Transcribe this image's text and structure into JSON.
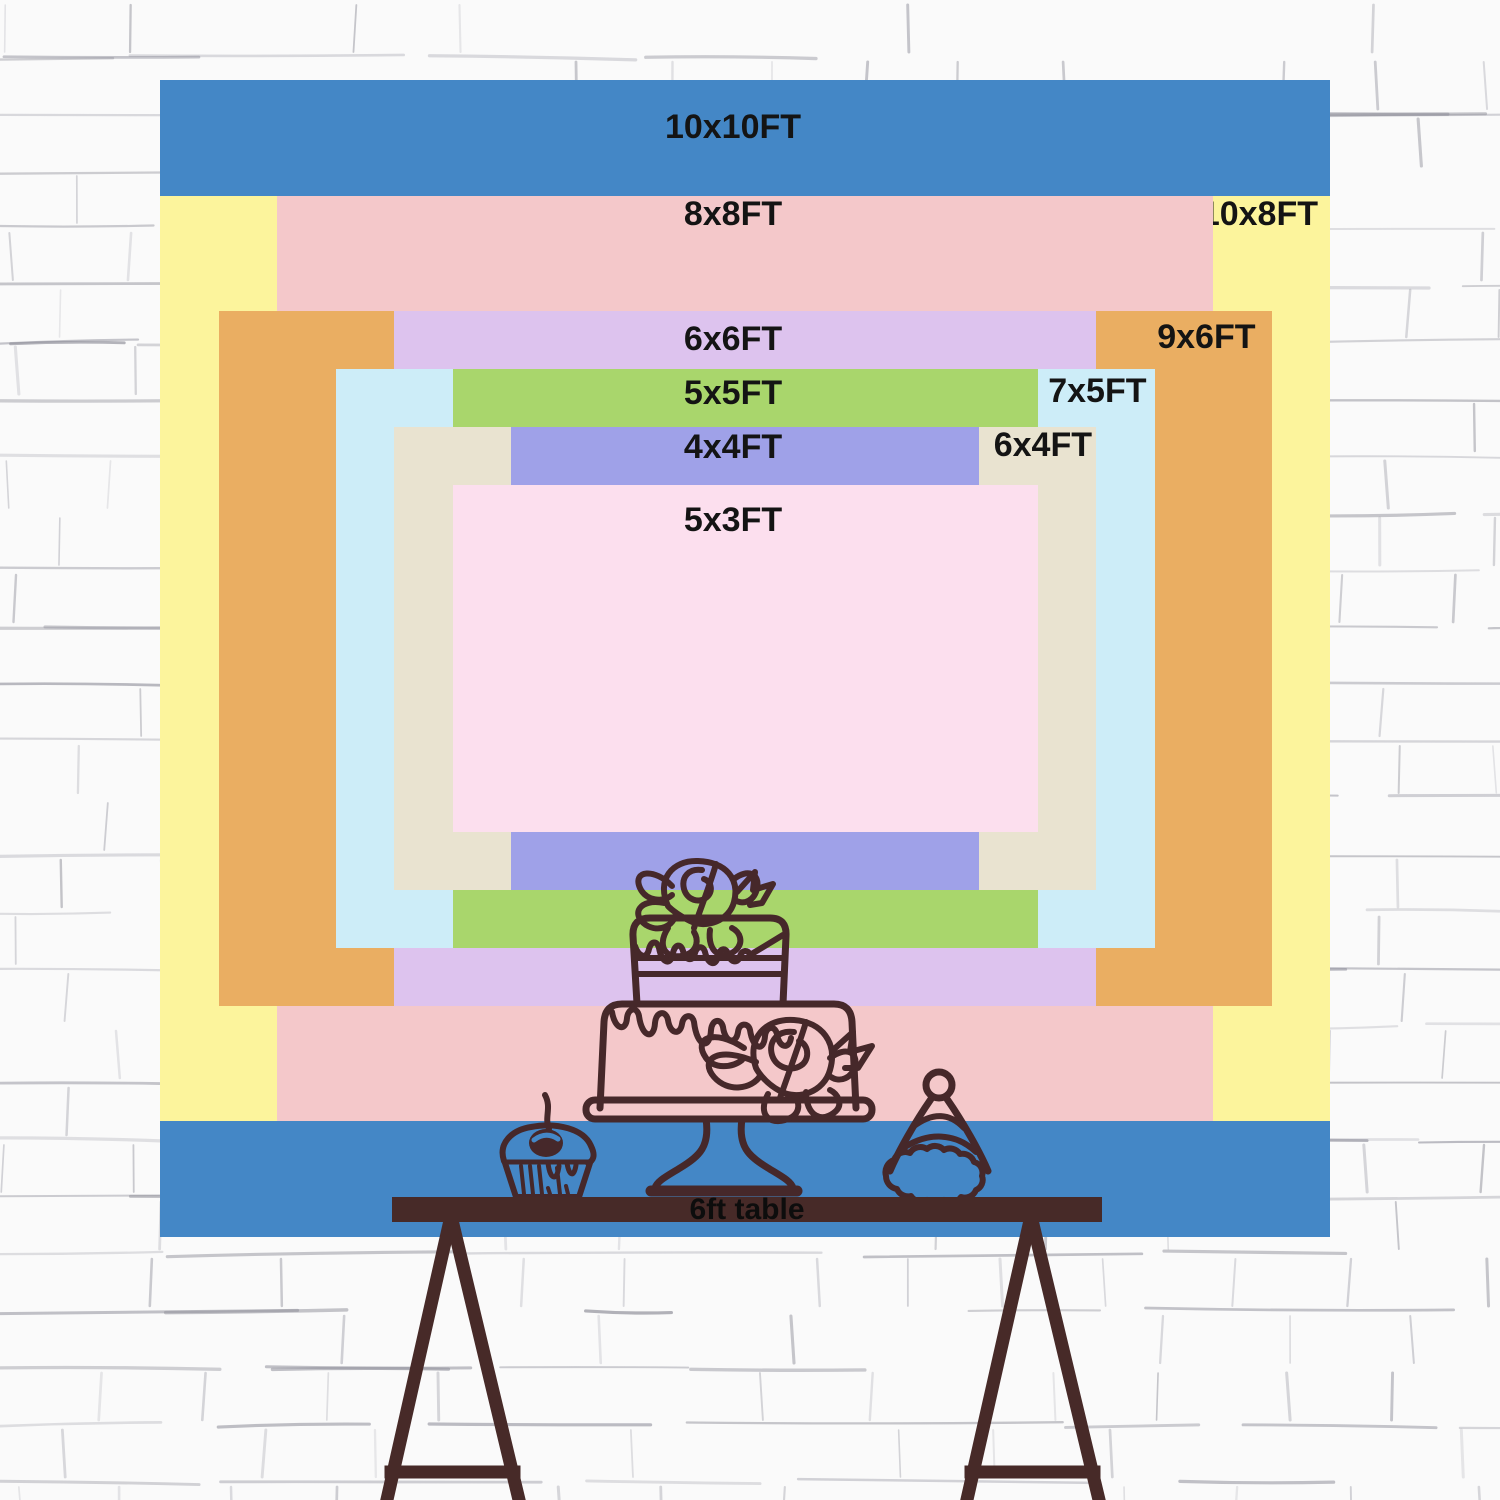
{
  "wall": {
    "background": "#fafafa",
    "mortar_line_color": "#8f8f9a"
  },
  "backdrop": {
    "sizes": [
      {
        "id": "10x10",
        "label": "10x10FT",
        "w_ft": 10,
        "h_ft": 10,
        "color": "#4487c6",
        "label_pos": "top-center"
      },
      {
        "id": "10x8",
        "label": "10x8FT",
        "w_ft": 10,
        "h_ft": 8,
        "color": "#fcf49c",
        "label_pos": "top-right"
      },
      {
        "id": "8x8",
        "label": "8x8FT",
        "w_ft": 8,
        "h_ft": 8,
        "color": "#f4c8ca",
        "label_pos": "top-center"
      },
      {
        "id": "9x6",
        "label": "9x6FT",
        "w_ft": 9,
        "h_ft": 6,
        "color": "#eaae62",
        "label_pos": "top-right"
      },
      {
        "id": "6x6",
        "label": "6x6FT",
        "w_ft": 6,
        "h_ft": 6,
        "color": "#ddc3ee",
        "label_pos": "top-center"
      },
      {
        "id": "7x5",
        "label": "7x5FT",
        "w_ft": 7,
        "h_ft": 5,
        "color": "#cdedf8",
        "label_pos": "top-right"
      },
      {
        "id": "5x5",
        "label": "5x5FT",
        "w_ft": 5,
        "h_ft": 5,
        "color": "#a9d66c",
        "label_pos": "top-center"
      },
      {
        "id": "6x4",
        "label": "6x4FT",
        "w_ft": 6,
        "h_ft": 4,
        "color": "#e9e3d0",
        "label_pos": "top-right"
      },
      {
        "id": "4x4",
        "label": "4x4FT",
        "w_ft": 4,
        "h_ft": 4,
        "color": "#9fa1e8",
        "label_pos": "top-center"
      },
      {
        "id": "5x3",
        "label": "5x3FT",
        "w_ft": 5,
        "h_ft": 3,
        "color": "#fcdfee",
        "label_pos": "top-center"
      }
    ]
  },
  "table": {
    "label": "6ft table",
    "color": "#472a28"
  },
  "illustration": {
    "line_color": "#46282a",
    "items": [
      "birthday-cake",
      "cupcake",
      "party-hat"
    ]
  }
}
